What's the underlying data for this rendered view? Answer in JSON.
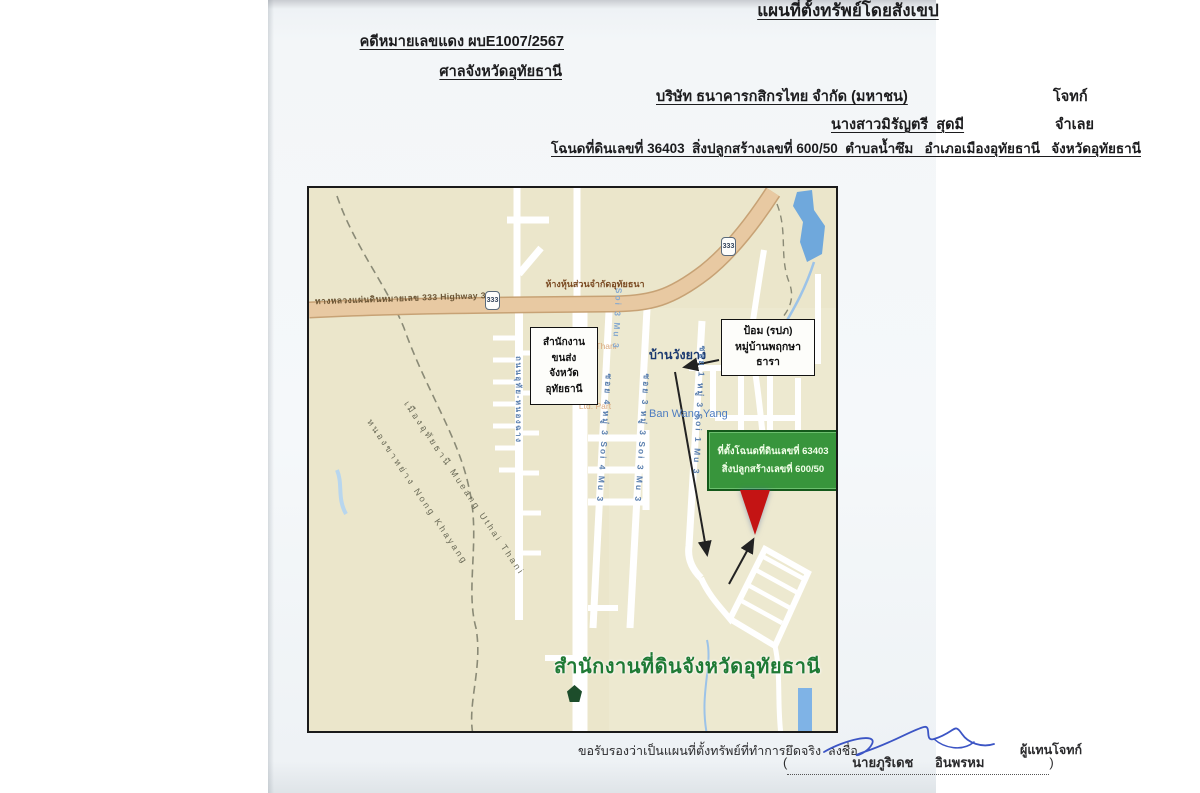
{
  "document": {
    "title": "แผนที่ตั้งทรัพย์โดยสังเขป",
    "case_no": "คดีหมายเลขแดง ผบE1007/2567",
    "court": "ศาลจังหวัดอุทัยธานี",
    "plaintiff": "บริษัท ธนาคารกสิกรไทย จำกัด (มหาชน)",
    "plaintiff_role": "โจทก์",
    "defendant": "นางสาวมิรัญตรี  สุดมี",
    "defendant_role": "จำเลย",
    "property_line": "โฉนดที่ดินเลขที่ 36403  สิ่งปลูกสร้างเลขที่ 600/50  ตำบลน้ำซึม   อำเภอเมืองอุทัยธานี   จังหวัดอุทัยธานี"
  },
  "map": {
    "highway_label": "ทางหลวงแผ่นดินหมายเลข 333 Highway 333",
    "highway_shield": "333",
    "poi_partnership": {
      "thai": "ห้างหุ้นส่วนจำกัดอุทัยธนา",
      "en1": "Uthai Thani",
      "en2": "Ltd. Part"
    },
    "village": {
      "thai": "บ้านวังยาง",
      "en": "Ban Wang Yang"
    },
    "transport_office_box": {
      "line1": "สำนักงาน",
      "line2": "ขนส่ง",
      "line3": "จังหวัด",
      "line4": "อุทัยธานี"
    },
    "guard_box": {
      "line1": "ป้อม (รปภ)",
      "line2": "หมู่บ้านพฤกษา",
      "line3": "ธารา"
    },
    "parcel_box": {
      "line1": "ที่ตั้งโฉนดที่ดินเลขที่ 63403",
      "line2": "สิ่งปลูกสร้างเลขที่ 600/50"
    },
    "land_office": "สำนักงานที่ดินจังหวัดอุทัยธานี",
    "boundary": {
      "upper": "เมืองอุทัยธานี Mueang Uthai Thani",
      "lower": "หนองขาหย่าง Nong Khayang"
    },
    "streets": {
      "road_left": "ถนนอุทัย-หนองฉาง",
      "soi4": "ซอย 4 หมู่ 3 Soi 4 Mu 3",
      "soi3_top": "Soi 3 Mu 3",
      "soi3": "ซอย 3 หมู่ 3 Soi 3 Mu 3",
      "soi1": "ซอย 1 หมู่ 3 Soi 1 Mu 3"
    }
  },
  "footer": {
    "certify": "ขอรับรองว่าเป็นแผนที่ตั้งทรัพย์ที่ทำการยึดจริง  ลงชื่อ",
    "representative": "ผู้แทนโจทก์",
    "paren_open": "(",
    "signer_name": "นายภูริเดช      อินพรหม",
    "paren_close": ")"
  },
  "colors": {
    "map_background": "#ebe6cb",
    "highway_fill": "#e3c19b",
    "parcel_box_green": "#38953c",
    "pin_red": "#c41414",
    "land_office_green": "#1f7a35",
    "street_label_blue": "#5a7fae",
    "signature_blue": "#3c55c5"
  }
}
